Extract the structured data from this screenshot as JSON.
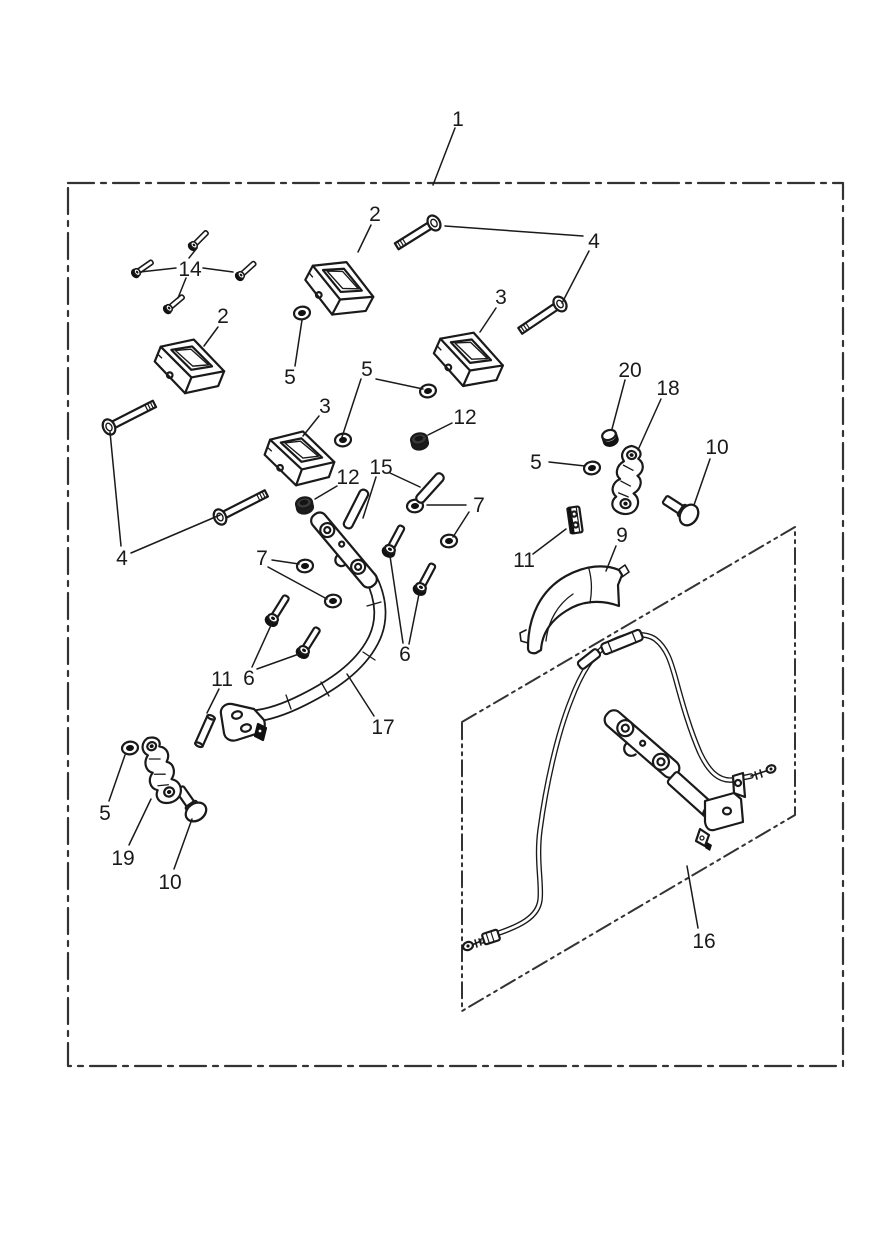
{
  "document": {
    "type": "exploded-parts-diagram",
    "background": "#ffffff",
    "line_color": "#1a1a1a",
    "border_style": "dash-dot"
  },
  "part_numbers_visible": [
    "1",
    "2",
    "3",
    "4",
    "5",
    "6",
    "7",
    "9",
    "10",
    "11",
    "12",
    "14",
    "15",
    "16",
    "17",
    "18",
    "19",
    "20"
  ],
  "callouts": {
    "c1": "1",
    "c2a": "2",
    "c2b": "2",
    "c3a": "3",
    "c3b": "3",
    "c4a": "4",
    "c4b": "4",
    "c5a": "5",
    "c5b": "5",
    "c5c": "5",
    "c5d": "5",
    "c6a": "6",
    "c6b": "6",
    "c7a": "7",
    "c7b": "7",
    "c9": "9",
    "c10a": "10",
    "c10b": "10",
    "c11a": "11",
    "c11b": "11",
    "c12a": "12",
    "c12b": "12",
    "c14": "14",
    "c15": "15",
    "c16": "16",
    "c17": "17",
    "c18": "18",
    "c19": "19",
    "c20": "20"
  }
}
